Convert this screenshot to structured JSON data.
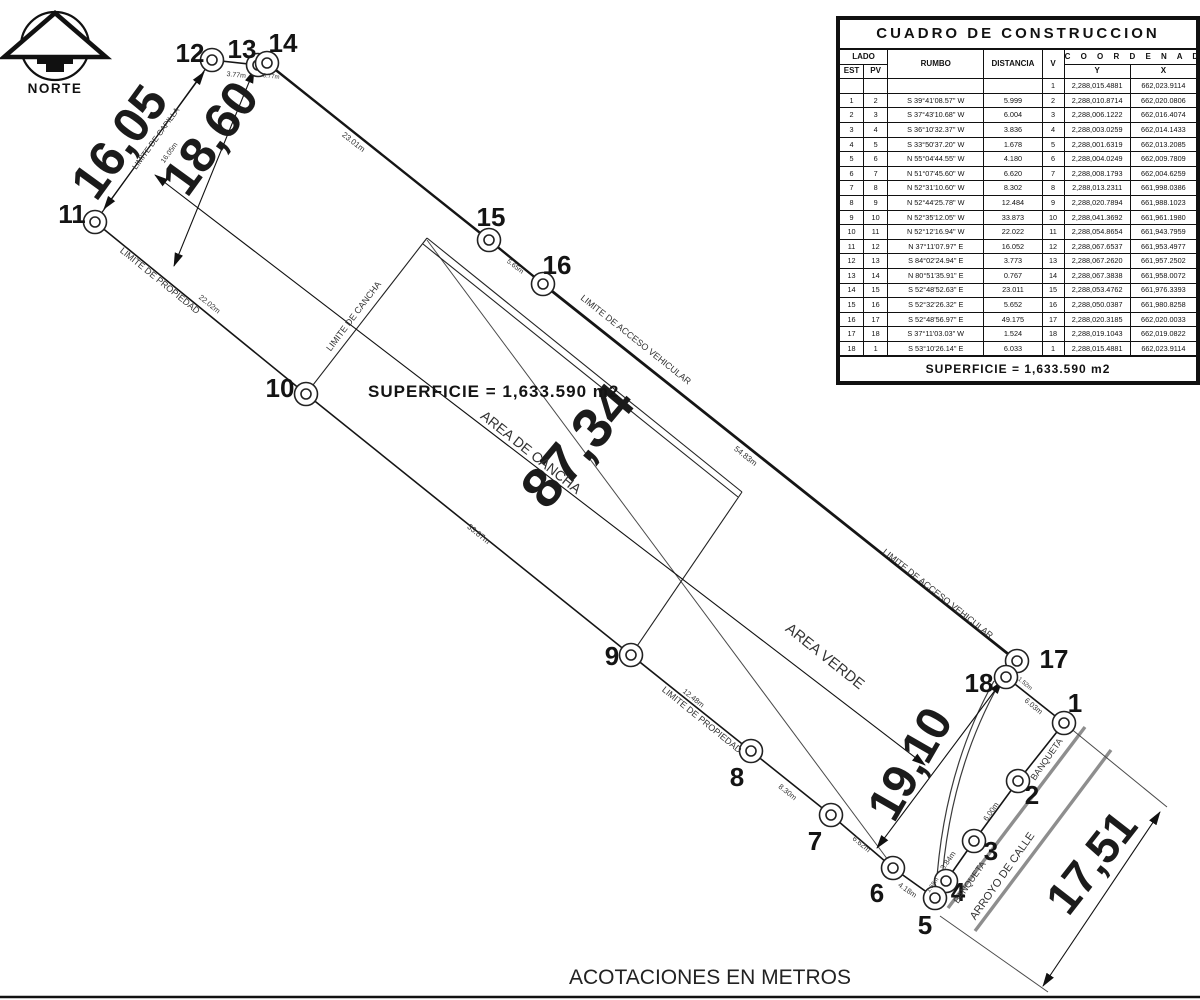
{
  "north": {
    "label": "NORTE"
  },
  "footer": {
    "note": "ACOTACIONES EN METROS"
  },
  "table": {
    "title": "CUADRO DE CONSTRUCCION",
    "headers": {
      "lado": "LADO",
      "est": "EST",
      "pv": "PV",
      "rumbo": "RUMBO",
      "distancia": "DISTANCIA",
      "v": "V",
      "coordenadas": "C O O R D E N A D A S",
      "y": "Y",
      "x": "X"
    },
    "superficie": "SUPERFICIE  =  1,633.590  m2",
    "rows": [
      {
        "est": "",
        "pv": "",
        "rumbo": "",
        "distancia": "",
        "v": "1",
        "y": "2,288,015.4881",
        "x": "662,023.9114"
      },
      {
        "est": "1",
        "pv": "2",
        "rumbo": "S 39°41'08.57\" W",
        "distancia": "5.999",
        "v": "2",
        "y": "2,288,010.8714",
        "x": "662,020.0806"
      },
      {
        "est": "2",
        "pv": "3",
        "rumbo": "S 37°43'10.68\" W",
        "distancia": "6.004",
        "v": "3",
        "y": "2,288,006.1222",
        "x": "662,016.4074"
      },
      {
        "est": "3",
        "pv": "4",
        "rumbo": "S 36°10'32.37\" W",
        "distancia": "3.836",
        "v": "4",
        "y": "2,288,003.0259",
        "x": "662,014.1433"
      },
      {
        "est": "4",
        "pv": "5",
        "rumbo": "S 33°50'37.20\" W",
        "distancia": "1.678",
        "v": "5",
        "y": "2,288,001.6319",
        "x": "662,013.2085"
      },
      {
        "est": "5",
        "pv": "6",
        "rumbo": "N 55°04'44.55\" W",
        "distancia": "4.180",
        "v": "6",
        "y": "2,288,004.0249",
        "x": "662,009.7809"
      },
      {
        "est": "6",
        "pv": "7",
        "rumbo": "N 51°07'45.60\" W",
        "distancia": "6.620",
        "v": "7",
        "y": "2,288,008.1793",
        "x": "662,004.6259"
      },
      {
        "est": "7",
        "pv": "8",
        "rumbo": "N 52°31'10.60\" W",
        "distancia": "8.302",
        "v": "8",
        "y": "2,288,013.2311",
        "x": "661,998.0386"
      },
      {
        "est": "8",
        "pv": "9",
        "rumbo": "N 52°44'25.78\" W",
        "distancia": "12.484",
        "v": "9",
        "y": "2,288,020.7894",
        "x": "661,988.1023"
      },
      {
        "est": "9",
        "pv": "10",
        "rumbo": "N 52°35'12.05\" W",
        "distancia": "33.873",
        "v": "10",
        "y": "2,288,041.3692",
        "x": "661,961.1980"
      },
      {
        "est": "10",
        "pv": "11",
        "rumbo": "N 52°12'16.94\" W",
        "distancia": "22.022",
        "v": "11",
        "y": "2,288,054.8654",
        "x": "661,943.7959"
      },
      {
        "est": "11",
        "pv": "12",
        "rumbo": "N 37°11'07.97\" E",
        "distancia": "16.052",
        "v": "12",
        "y": "2,288,067.6537",
        "x": "661,953.4977"
      },
      {
        "est": "12",
        "pv": "13",
        "rumbo": "S 84°02'24.94\" E",
        "distancia": "3.773",
        "v": "13",
        "y": "2,288,067.2620",
        "x": "661,957.2502"
      },
      {
        "est": "13",
        "pv": "14",
        "rumbo": "N 80°51'35.91\" E",
        "distancia": "0.767",
        "v": "14",
        "y": "2,288,067.3838",
        "x": "661,958.0072"
      },
      {
        "est": "14",
        "pv": "15",
        "rumbo": "S 52°48'52.63\" E",
        "distancia": "23.011",
        "v": "15",
        "y": "2,288,053.4762",
        "x": "661,976.3393"
      },
      {
        "est": "15",
        "pv": "16",
        "rumbo": "S 52°32'26.32\" E",
        "distancia": "5.652",
        "v": "16",
        "y": "2,288,050.0387",
        "x": "661,980.8258"
      },
      {
        "est": "16",
        "pv": "17",
        "rumbo": "S 52°48'56.97\" E",
        "distancia": "49.175",
        "v": "17",
        "y": "2,288,020.3185",
        "x": "662,020.0033"
      },
      {
        "est": "17",
        "pv": "18",
        "rumbo": "S 37°11'03.03\" W",
        "distancia": "1.524",
        "v": "18",
        "y": "2,288,019.1043",
        "x": "662,019.0822"
      },
      {
        "est": "18",
        "pv": "1",
        "rumbo": "S 53°10'26.14\" E",
        "distancia": "6.033",
        "v": "1",
        "y": "2,288,015.4881",
        "x": "662,023.9114"
      }
    ]
  },
  "plan": {
    "superficie": "SUPERFICIE  =  1,633.590  m2",
    "vertices": [
      {
        "n": 1,
        "x": 1064,
        "y": 723,
        "lx": 1075,
        "ly": 712
      },
      {
        "n": 2,
        "x": 1018,
        "y": 781,
        "lx": 1032,
        "ly": 804
      },
      {
        "n": 3,
        "x": 974,
        "y": 841,
        "lx": 991,
        "ly": 860
      },
      {
        "n": 4,
        "x": 946,
        "y": 881,
        "lx": 958,
        "ly": 901
      },
      {
        "n": 5,
        "x": 935,
        "y": 898,
        "lx": 925,
        "ly": 934
      },
      {
        "n": 6,
        "x": 893,
        "y": 868,
        "lx": 877,
        "ly": 902
      },
      {
        "n": 7,
        "x": 831,
        "y": 815,
        "lx": 815,
        "ly": 850
      },
      {
        "n": 8,
        "x": 751,
        "y": 751,
        "lx": 737,
        "ly": 786
      },
      {
        "n": 9,
        "x": 631,
        "y": 655,
        "lx": 612,
        "ly": 665
      },
      {
        "n": 10,
        "x": 306,
        "y": 394,
        "lx": 280,
        "ly": 397
      },
      {
        "n": 11,
        "x": 95,
        "y": 222,
        "lx": 72,
        "ly": 223
      },
      {
        "n": 12,
        "x": 212,
        "y": 60,
        "lx": 190,
        "ly": 62
      },
      {
        "n": 13,
        "x": 258,
        "y": 65,
        "lx": 242,
        "ly": 58
      },
      {
        "n": 14,
        "x": 267,
        "y": 63,
        "lx": 283,
        "ly": 52
      },
      {
        "n": 15,
        "x": 489,
        "y": 240,
        "lx": 491,
        "ly": 226
      },
      {
        "n": 16,
        "x": 543,
        "y": 284,
        "lx": 557,
        "ly": 274
      },
      {
        "n": 17,
        "x": 1017,
        "y": 661,
        "lx": 1054,
        "ly": 668
      },
      {
        "n": 18,
        "x": 1006,
        "y": 677,
        "lx": 979,
        "ly": 692
      }
    ],
    "edges": [
      [
        1,
        2,
        1.6
      ],
      [
        2,
        3,
        1.6
      ],
      [
        3,
        4,
        1.6
      ],
      [
        4,
        5,
        1.6
      ],
      [
        5,
        6,
        1.6
      ],
      [
        6,
        7,
        1.6
      ],
      [
        7,
        8,
        1.6
      ],
      [
        8,
        9,
        1.6
      ],
      [
        9,
        10,
        1.6
      ],
      [
        10,
        11,
        1.6
      ],
      [
        11,
        12,
        1.2
      ],
      [
        12,
        13,
        1.6
      ],
      [
        13,
        14,
        1.6
      ],
      [
        14,
        15,
        2.4
      ],
      [
        15,
        16,
        2.4
      ],
      [
        16,
        17,
        2.8
      ],
      [
        17,
        18,
        1.6
      ],
      [
        18,
        1,
        1.6
      ]
    ],
    "cancha_lines": [
      [
        306,
        394,
        427,
        238
      ],
      [
        427,
        238,
        742,
        492
      ],
      [
        423,
        244,
        738,
        497
      ],
      [
        742,
        492,
        631,
        655
      ]
    ],
    "aux_lines": [
      [
        427,
        240,
        891,
        864
      ],
      [
        1064,
        723,
        1167,
        807
      ],
      [
        940,
        916,
        1048,
        992
      ]
    ],
    "streets": [
      [
        1085,
        727,
        948,
        908
      ],
      [
        1111,
        750,
        975,
        931
      ]
    ],
    "curves": [
      "M999,684 Q948,775 941,894",
      "M994,681 Q943,772 936,891"
    ],
    "dim_lines": [
      [
        104,
        209,
        204,
        72
      ],
      [
        254,
        70,
        174,
        266
      ],
      [
        155,
        175,
        925,
        765
      ],
      [
        1002,
        681,
        877,
        848
      ],
      [
        1160,
        812,
        1043,
        986
      ]
    ],
    "labels": [
      {
        "t": "16,05",
        "x": 133,
        "y": 152,
        "r": -54,
        "s": 50,
        "b": 1,
        "c": "#1b1b1b",
        "n": "dim-16-05"
      },
      {
        "t": "18,60",
        "x": 224,
        "y": 148,
        "r": -54,
        "s": 50,
        "b": 1,
        "c": "#1b1b1b",
        "n": "dim-18-60"
      },
      {
        "t": "87,34",
        "x": 592,
        "y": 458,
        "r": -50,
        "s": 56,
        "b": 1,
        "c": "#1b1b1b",
        "n": "dim-87-34"
      },
      {
        "t": "19,10",
        "x": 924,
        "y": 772,
        "r": -60,
        "s": 48,
        "b": 1,
        "c": "#1b1b1b",
        "n": "dim-19-10"
      },
      {
        "t": "17,51",
        "x": 1104,
        "y": 872,
        "r": -52,
        "s": 46,
        "b": 1,
        "c": "#1b1b1b",
        "n": "dim-17-51"
      },
      {
        "t": "LIMITE DE CAPILLA",
        "x": 158,
        "y": 140,
        "r": -54,
        "s": 8,
        "n": "label-limite-de-capilla"
      },
      {
        "t": "16.05m",
        "x": 171,
        "y": 154,
        "r": -54,
        "s": 7,
        "n": "label-16-05m"
      },
      {
        "t": "3.77m",
        "x": 236,
        "y": 77,
        "r": 6,
        "s": 7,
        "n": "label-3-77m"
      },
      {
        "t": "0.77m",
        "x": 271,
        "y": 78,
        "r": 6,
        "s": 6,
        "n": "label-0-77m"
      },
      {
        "t": "23.01m",
        "x": 352,
        "y": 144,
        "r": 38.5,
        "s": 8,
        "n": "label-23-01m"
      },
      {
        "t": "5.65m",
        "x": 514,
        "y": 268,
        "r": 38.5,
        "s": 7,
        "n": "label-5-65m"
      },
      {
        "t": "LIMITE DE ACCESO VEHICULAR",
        "x": 634,
        "y": 342,
        "r": 38.5,
        "s": 9,
        "n": "label-limite-acceso-vehicular-1"
      },
      {
        "t": "54.83m",
        "x": 744,
        "y": 458,
        "r": 38.5,
        "s": 8,
        "n": "label-54-83m"
      },
      {
        "t": "LIMITE DE ACCESO VEHICULAR",
        "x": 936,
        "y": 596,
        "r": 38.5,
        "s": 9,
        "n": "label-limite-acceso-vehicular-2"
      },
      {
        "t": "LIMITE DE PROPIEDAD",
        "x": 158,
        "y": 283,
        "r": 39,
        "s": 9,
        "n": "label-limite-propiedad-1"
      },
      {
        "t": "22.02m",
        "x": 208,
        "y": 306,
        "r": 39,
        "s": 7.5,
        "n": "label-22-02m"
      },
      {
        "t": "33.87m",
        "x": 477,
        "y": 536,
        "r": 39,
        "s": 8,
        "n": "label-33-87m"
      },
      {
        "t": "LIMITE DE CANCHA",
        "x": 356,
        "y": 318,
        "r": -53,
        "s": 9,
        "n": "label-limite-de-cancha"
      },
      {
        "t": "AREA DE CANCHA",
        "x": 528,
        "y": 456,
        "r": 38.5,
        "s": 14,
        "n": "label-area-de-cancha"
      },
      {
        "t": "AREA VERDE",
        "x": 822,
        "y": 660,
        "r": 38.5,
        "s": 15,
        "n": "label-area-verde"
      },
      {
        "t": "12.48m",
        "x": 692,
        "y": 700,
        "r": 39,
        "s": 7.5,
        "n": "label-12-48m"
      },
      {
        "t": "LIMITE DE PROPIEDAD",
        "x": 700,
        "y": 722,
        "r": 39,
        "s": 9,
        "n": "label-limite-propiedad-2"
      },
      {
        "t": "8.30m",
        "x": 786,
        "y": 794,
        "r": 39,
        "s": 7.5,
        "n": "label-8-30m"
      },
      {
        "t": "6.62m",
        "x": 860,
        "y": 846,
        "r": 40,
        "s": 7.5,
        "n": "label-6-62m"
      },
      {
        "t": "4.18m",
        "x": 906,
        "y": 892,
        "r": 35,
        "s": 7.5,
        "n": "label-4-18m"
      },
      {
        "t": "1.68m",
        "x": 934,
        "y": 886,
        "r": -55,
        "s": 6,
        "n": "label-1-68m"
      },
      {
        "t": "3.84m",
        "x": 950,
        "y": 862,
        "r": -55,
        "s": 7.5,
        "n": "label-3-84m"
      },
      {
        "t": "BANQUETA",
        "x": 972,
        "y": 884,
        "r": -55,
        "s": 9,
        "n": "label-banqueta-1"
      },
      {
        "t": "ARROYO DE CALLE",
        "x": 1005,
        "y": 878,
        "r": -55,
        "s": 11,
        "n": "label-arroyo-de-calle"
      },
      {
        "t": "6.00m",
        "x": 993,
        "y": 813,
        "r": -55,
        "s": 7.5,
        "n": "label-6-00m"
      },
      {
        "t": "BANQUETA",
        "x": 1049,
        "y": 761,
        "r": -55,
        "s": 9,
        "n": "label-banqueta-2"
      },
      {
        "t": "6.03m",
        "x": 1032,
        "y": 708,
        "r": 40,
        "s": 7.5,
        "n": "label-6-03m"
      },
      {
        "t": "1.52m",
        "x": 1024,
        "y": 685,
        "r": 40,
        "s": 6,
        "n": "label-1-52m"
      }
    ]
  }
}
